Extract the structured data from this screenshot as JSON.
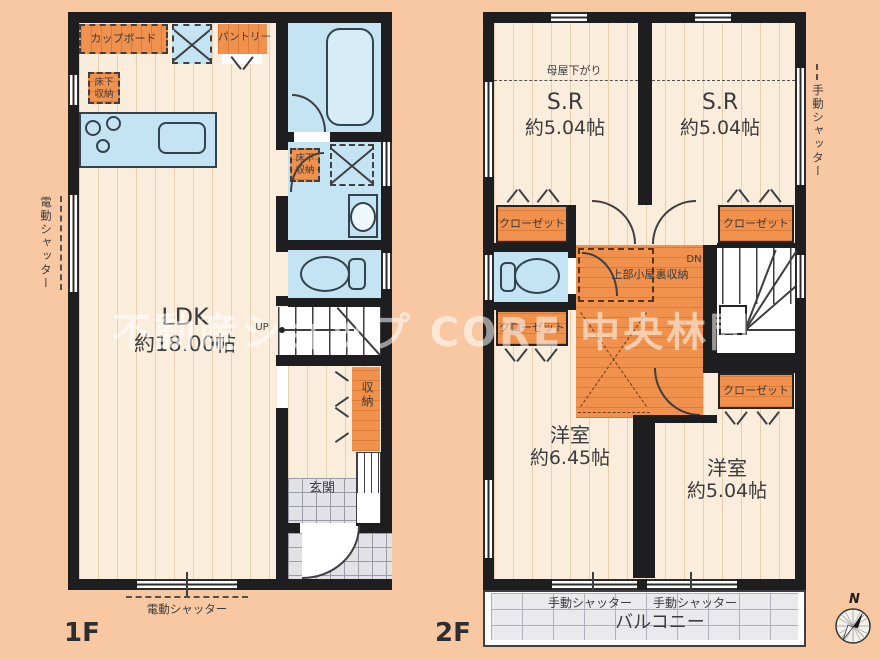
{
  "watermark": "不動産ショップ CORE 中央林間",
  "compass": {
    "n": "N"
  },
  "f1": {
    "floor_label": "1F",
    "ldk": "LDK",
    "ldk_size": "約18.00帖",
    "cupboard": "カップボード",
    "pantry": "パントリー",
    "underfloor_a": "床下収納",
    "underfloor_b": "床下収納",
    "storage": "収納",
    "entrance": "玄関",
    "up": "UP",
    "shutter_left": "電動シャッター",
    "shutter_bottom": "電動シャッター"
  },
  "f2": {
    "floor_label": "2F",
    "moya": "母屋下がり",
    "sr1": "S.R",
    "sr1_size": "約5.04帖",
    "sr2": "S.R",
    "sr2_size": "約5.04帖",
    "room1": "洋室",
    "room1_size": "約6.45帖",
    "room2": "洋室",
    "room2_size": "約5.04帖",
    "closet_tl": "クローゼット",
    "closet_tr": "クローゼット",
    "closet_ml": "クローゼット",
    "closet_mr": "クローゼット",
    "attic": "上部小屋裏収納",
    "dn": "DN",
    "balcony": "バルコニー",
    "shutter1": "手動シャッター",
    "shutter2": "手動シャッター",
    "shutter_right": "手動シャッター"
  }
}
